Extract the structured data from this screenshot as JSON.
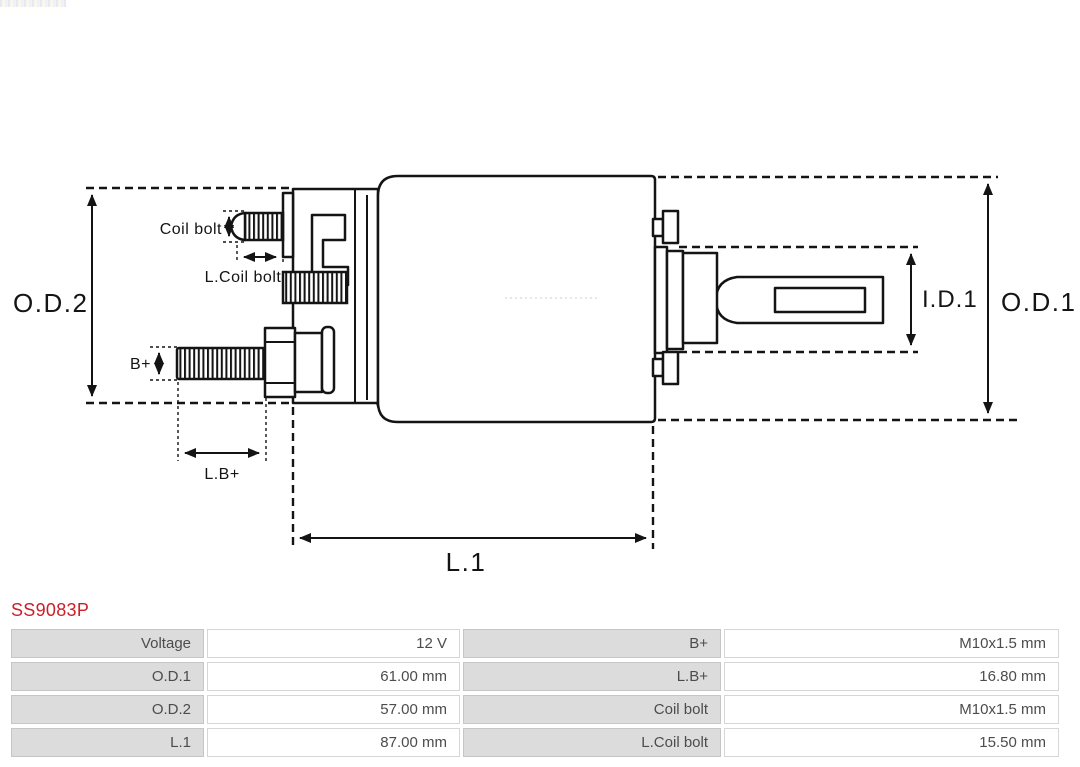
{
  "product": {
    "code": "SS9083P"
  },
  "diagram": {
    "labels": {
      "od2": "O.D.2",
      "od1": "O.D.1",
      "id1": "I.D.1",
      "l1": "L.1",
      "bplus": "B+",
      "lbplus": "L.B+",
      "coil_bolt": "Coil bolt",
      "l_coil_bolt": "L.Coil bolt"
    }
  },
  "spec_table": {
    "rows": [
      {
        "label1": "Voltage",
        "value1": "12 V",
        "label2": "B+",
        "value2": "M10x1.5 mm"
      },
      {
        "label1": "O.D.1",
        "value1": "61.00 mm",
        "label2": "L.B+",
        "value2": "16.80 mm"
      },
      {
        "label1": "O.D.2",
        "value1": "57.00 mm",
        "label2": "Coil bolt",
        "value2": "M10x1.5 mm"
      },
      {
        "label1": "L.1",
        "value1": "87.00 mm",
        "label2": "L.Coil bolt",
        "value2": "15.50 mm"
      }
    ]
  },
  "colors": {
    "accent_red": "#cb2027",
    "line": "#141414",
    "label_cell_bg": "#dcdcdc"
  }
}
